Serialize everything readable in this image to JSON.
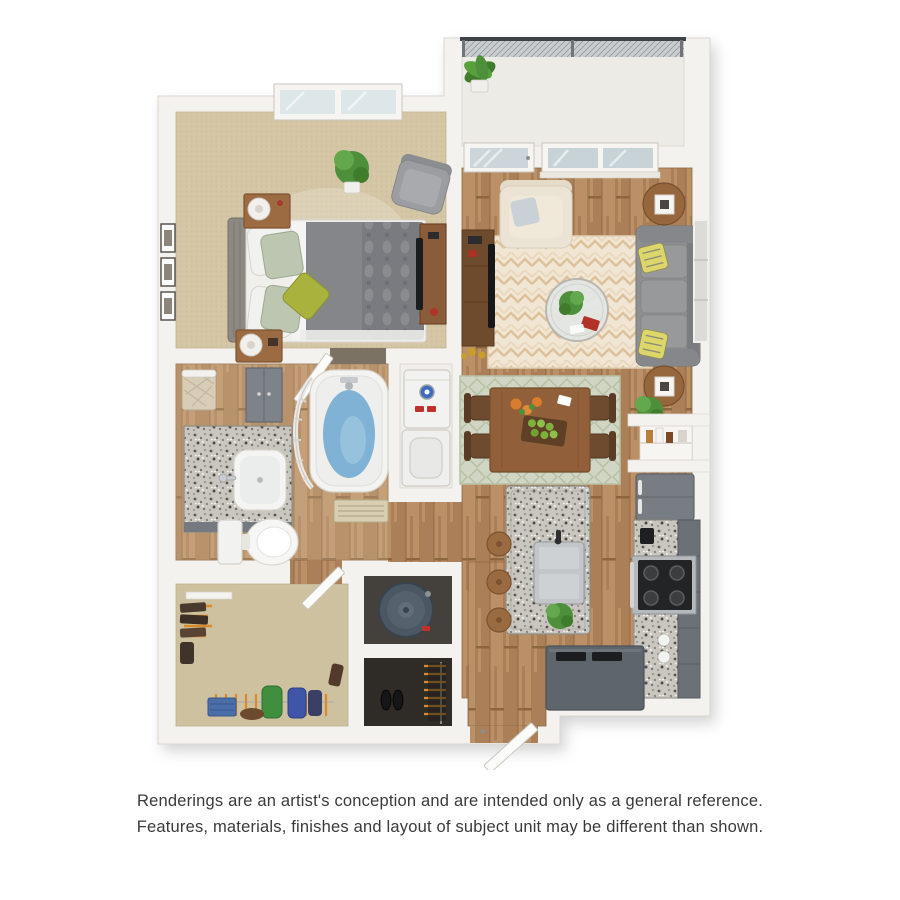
{
  "page": {
    "background_color": "#ffffff"
  },
  "caption": {
    "line1": "Renderings are an artist's conception and are intended only as a general reference.",
    "line2": "Features, materials, finishes and layout of subject unit may be different than shown.",
    "text_color": "#3a3a3a"
  },
  "floorplan": {
    "kind": "3D-rendered apartment floor plan, top-down view, one bedroom / one bathroom",
    "rooms": [
      {
        "name": "bedroom",
        "floor": "tan carpet",
        "contents": [
          "double window",
          "queen bed with gray tufted headboard, gray duvet, patterned pillows, olive accent pillow",
          "two wood nightstands with white drum lamps",
          "three framed pictures",
          "potted plant",
          "gray armchair",
          "wood media console with TV"
        ]
      },
      {
        "name": "balcony",
        "floor": "light concrete",
        "contents": [
          "black mesh railing",
          "potted plant"
        ]
      },
      {
        "name": "living-room",
        "floor": "wood plank",
        "contents": [
          "glass balcony door",
          "double window",
          "cream armchair with pillow",
          "cream chevron area rug",
          "round glass coffee table with plant and red book",
          "gray three-seat sofa with yellow patterned pillows",
          "two round end tables with white lantern lamps",
          "wall art panel",
          "walnut TV stand with flat TV and gold decor",
          "floor plant"
        ]
      },
      {
        "name": "dining-area",
        "floor": "wood plank",
        "contents": [
          "wood dining table",
          "four dark bentwood chairs",
          "sage basketweave rug",
          "orange flowers",
          "planter of green apples"
        ]
      },
      {
        "name": "kitchen",
        "floor": "wood plank",
        "contents": [
          "granite island with stainless sink and faucet",
          "three wood barstools",
          "potted plant",
          "gray refrigerator",
          "granite counter run",
          "black cooktop range",
          "tall gray cabinets",
          "dark gray peninsula counter with trays",
          "pantry niche with bottles"
        ]
      },
      {
        "name": "bathroom",
        "floor": "wood plank",
        "contents": [
          "granite vanity with sink",
          "wicker hamper",
          "gray linen cabinet",
          "toilet",
          "soaking tub with blue water and curved curtain rod",
          "floor register"
        ]
      },
      {
        "name": "laundry-closet",
        "floor": "vinyl",
        "contents": [
          "stacked washer and dryer with blue dial"
        ]
      },
      {
        "name": "walk-in-closet",
        "floor": "tan carpet",
        "contents": [
          "hanging rods",
          "orange hangers",
          "hanging clothes",
          "white shelf",
          "folded jeans",
          "shoes"
        ]
      },
      {
        "name": "utility-closet",
        "floor": "dark",
        "contents": [
          "round water heater"
        ]
      },
      {
        "name": "coat-closet",
        "floor": "dark",
        "contents": [
          "orange hangers",
          "hanging coats",
          "black shoes"
        ]
      },
      {
        "name": "entry",
        "floor": "wood plank",
        "contents": [
          "front door open inward"
        ]
      }
    ],
    "palette": {
      "wall": "#f3f2ee",
      "wall_edge": "#d8d4cc",
      "bedroom_carpet": "#d4c6a4",
      "closet_carpet": "#cec1a0",
      "wood_floor": "#b3895f",
      "living_rug": "#f1e6d4",
      "dining_rug": "#d0d6c3",
      "sofa_gray": "#8e8f91",
      "bed_duvet_gray": "#84868a",
      "accent_olive": "#a9b23c",
      "tub_water": "#7fb2d4",
      "cabinet_gray": "#6c7177",
      "peninsula_gray": "#5e656c",
      "granite": "#c9c6c0",
      "plant_green": "#4d8f3a",
      "hanger_orange": "#d98a2b",
      "water_heater_slate": "#4b5763",
      "wood_furniture": "#9c6b42"
    }
  }
}
